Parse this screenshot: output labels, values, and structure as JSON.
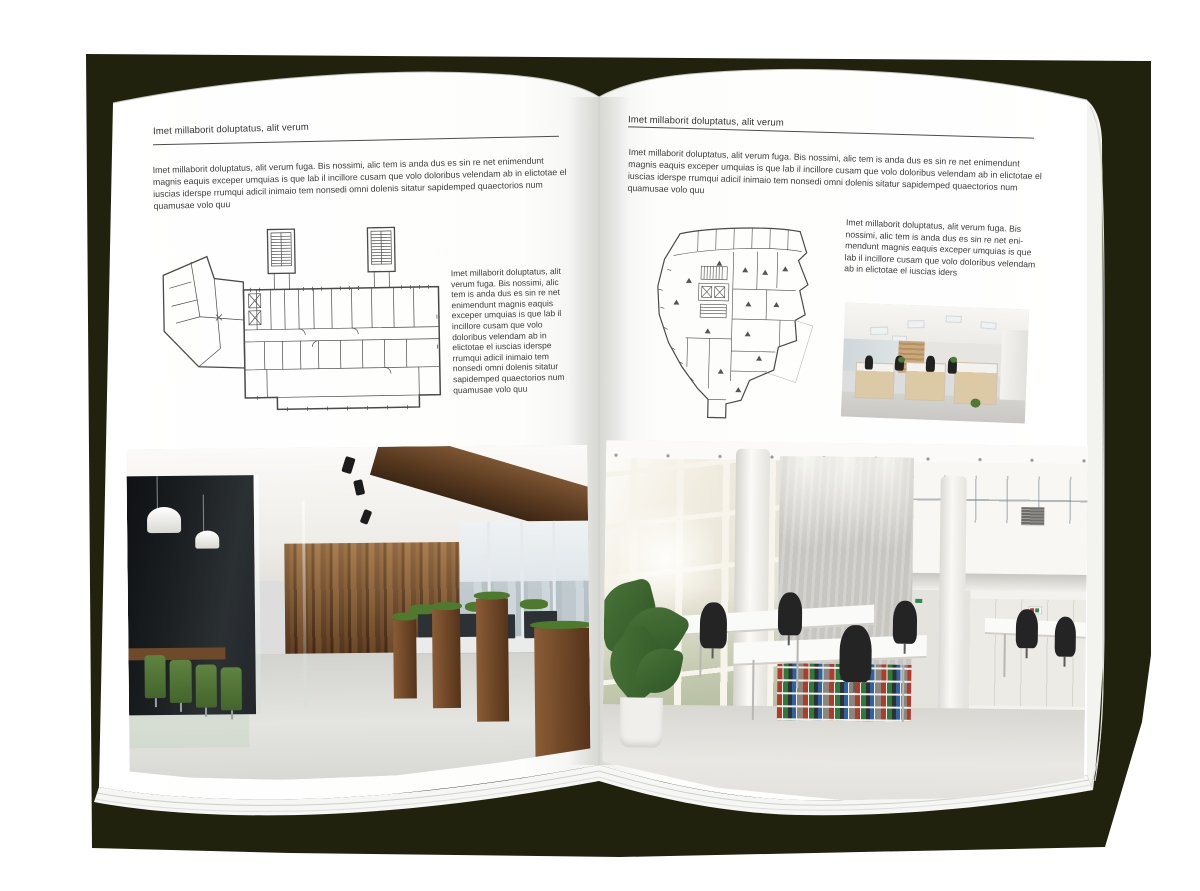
{
  "colors": {
    "backdrop": "#20220e",
    "page": "#ffffff",
    "text": "#3d3d3d",
    "rule": "#4d4d4d",
    "plan_line": "#4a4a4a"
  },
  "left_page": {
    "header": "Imet millaborit doluptatus, alit verum",
    "intro": "Imet millaborit doluptatus, alit verum fuga. Bis nossimi, alic tem is anda dus es sin re net enimendunt magnis eaquis exceper umquias is que lab il incillore cusam que volo doloribus velendam ab in elictotae el iuscias iderspe rrumqui adicil inimaio tem nonsedi omni dolenis sitatur sapidemped quaectorios num quamusae volo quu",
    "caption": "Imet millaborit doluptatus, alit verum fuga. Bis nossimi, alic tem is anda dus es sin re net enimendunt magnis eaquis exceper umquias is que lab il incillore cusam que volo doloribus velendam ab in elictotae el iuscias iderspe rrumqui adicil inimaio tem nonsedi omni dolenis sitatur sapidemped quaectorios num quamusae volo quu"
  },
  "right_page": {
    "header": "Imet millaborit doluptatus, alit verum",
    "intro": "Imet millaborit doluptatus, alit verum fuga. Bis nossimi, alic tem is anda dus es sin re net enimendunt magnis eaquis exceper umquias is que lab il incillore cusam que volo doloribus velendam ab in elictotae el iuscias iderspe rrumqui adicil inimaio tem nonsedi omni dolenis sitatur sapidemped quaectorios num quamusae volo quu",
    "caption": "Imet millaborit doluptatus, alit verum fuga. Bis nossimi, alic tem is anda dus es sin re net eni-mendunt magnis eaquis exceper umquias is que lab il incillore cusam que volo doloribus velendam ab in elictotae el iuscias iders"
  }
}
